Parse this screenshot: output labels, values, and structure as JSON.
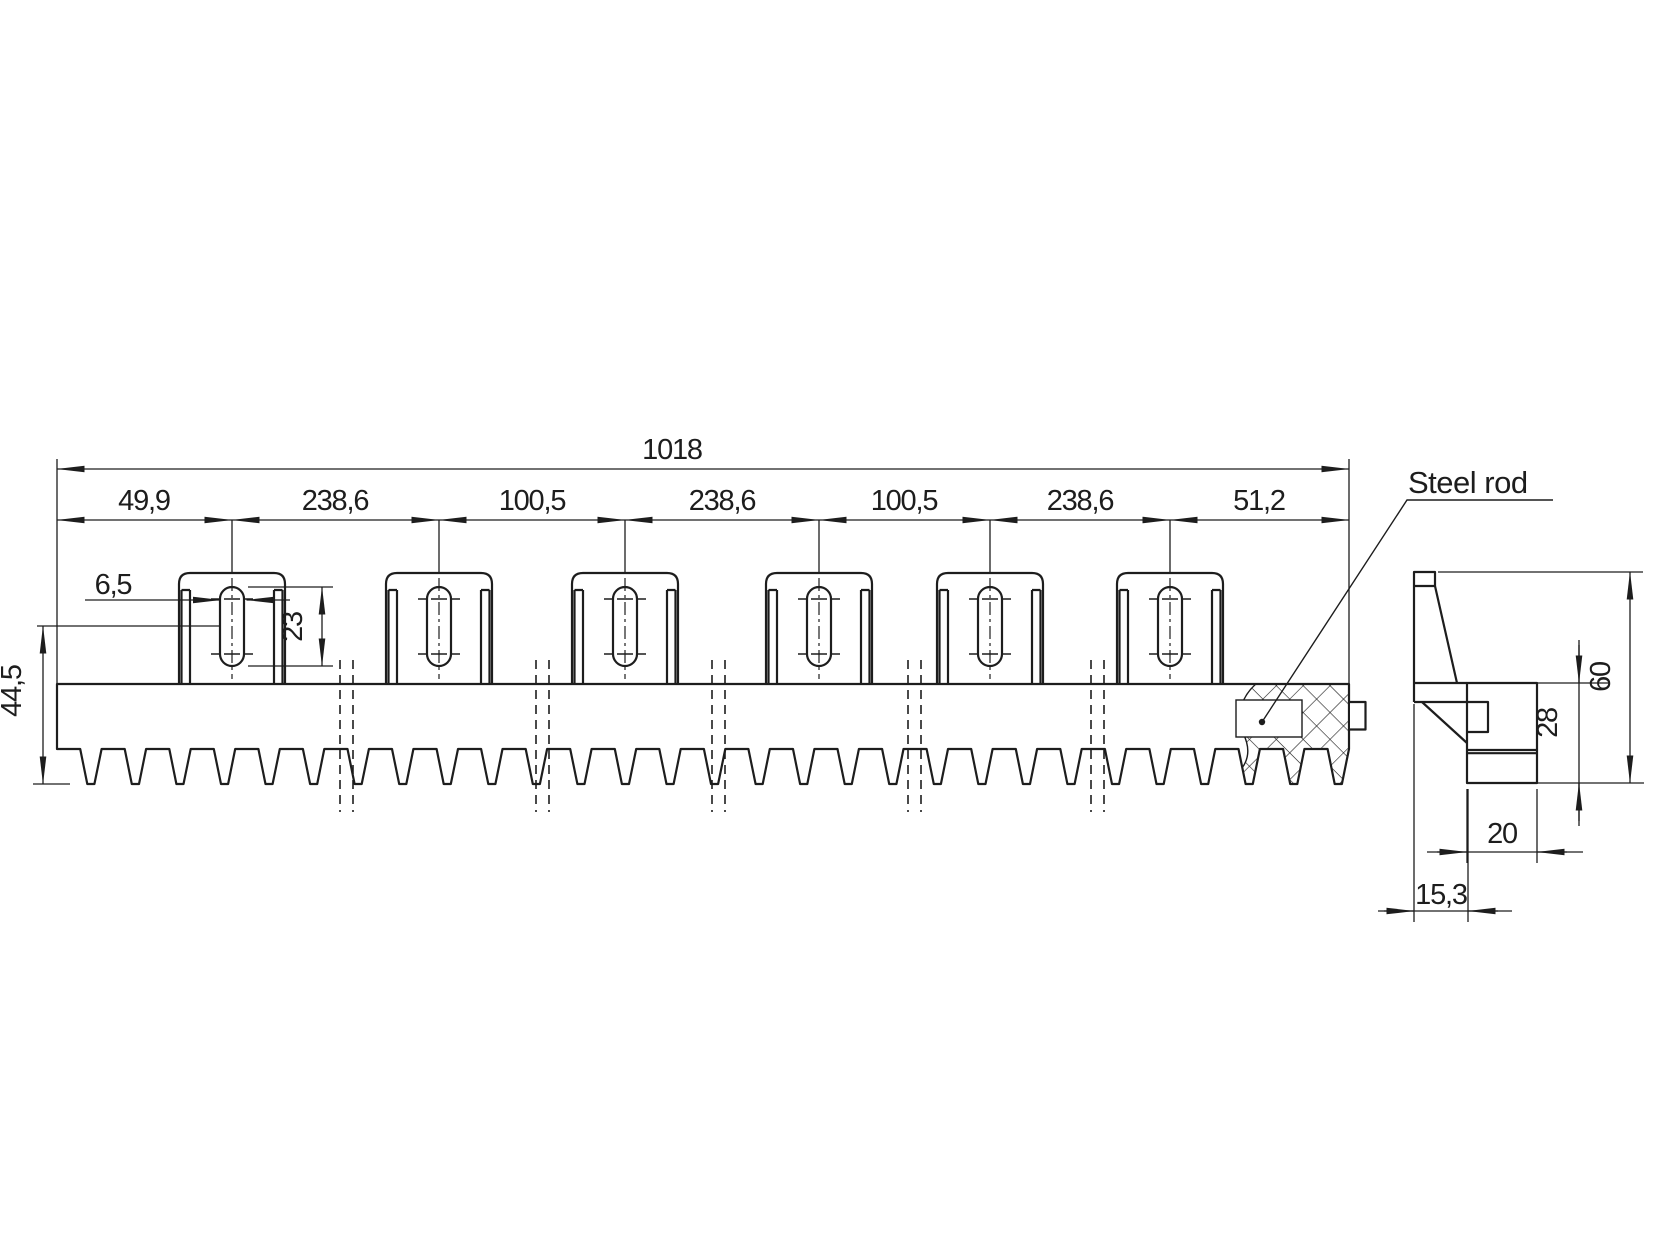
{
  "colors": {
    "line": "#1d1d1d",
    "background": "#ffffff"
  },
  "front_view": {
    "overall_length": "1018",
    "chain_dimensions": [
      "49,9",
      "238,6",
      "100,5",
      "238,6",
      "100,5",
      "238,6",
      "51,2"
    ],
    "slot_width": "6,5",
    "slot_length": "23",
    "rack_height": "44,5",
    "steel_rod_label": "Steel rod"
  },
  "side_view": {
    "overall_height": "60",
    "body_height": "28",
    "body_width": "20",
    "flange_offset": "15,3"
  }
}
